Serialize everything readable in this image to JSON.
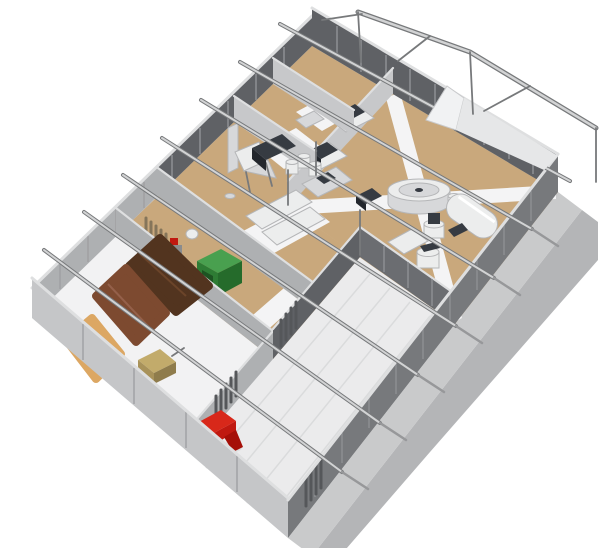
{
  "scene": {
    "type": "3d-isometric-cutaway-render",
    "subject": "Roofless cutaway model of a small feed-processing / mill facility viewed from above at an angle",
    "background": "#ffffff"
  },
  "palette": {
    "bg": "#ffffff",
    "floor_base": "#f2f2f3",
    "floor_tan": "#c9a87c",
    "floor_white": "#f4f4f5",
    "bay_floor": "#ebebec",
    "plank_line": "#dadbdc",
    "slab": "#c9cacb",
    "shadow": "#b4b5b7",
    "wall_dark": "#5f6165",
    "wall_dark2": "#6b6d71",
    "wall_mid": "#aeb0b2",
    "wall_light": "#c7c8ca",
    "wall_outer": "#c5c6c8",
    "wall_se": "#77797c",
    "wall_cap": "#dedfe0",
    "wall_rib_light": "#8b8d91",
    "wall_seam": "#9fa0a2",
    "metal": "#d2d3d4",
    "metal_dark": "#77797b",
    "stub": "#97989a",
    "slat_dark": "#55575a",
    "slat_wood": "#85755a",
    "pile_dark": "#52341f",
    "pile_red": "#7d4a30",
    "pile_tan": "#dca763",
    "green_top": "#49a04f",
    "green_front": "#2e7c34",
    "green_side": "#256b2b",
    "green_door": "#1d5422",
    "red_top": "#d8281a",
    "red_front": "#a50f08",
    "red_side": "#c01910",
    "tan_top": "#c2ab6b",
    "tan_front": "#a8925a",
    "tan_side": "#8f7c4c",
    "equip_white": "#eceded",
    "equip_shade": "#d7d8da",
    "equip_stroke": "#b5b6b8",
    "equip_dark": "#363b42",
    "equip_darker": "#23272d"
  },
  "building": {
    "footprint_px": {
      "west": [
        32,
        318
      ],
      "north": [
        312,
        46
      ],
      "east": [
        558,
        192
      ],
      "south": [
        288,
        538
      ]
    },
    "rooms": [
      {
        "name": "bulk-storage-room",
        "position": "south-west end",
        "features": [
          "dark-brown-pile",
          "red-brown-pile",
          "tan-pile",
          "bagging-machine",
          "louvered-gate"
        ]
      },
      {
        "name": "generator-room",
        "position": "mid north-west row",
        "features": [
          "green-generator",
          "small-mixer",
          "wood-slat-screen"
        ]
      },
      {
        "name": "milling-room",
        "position": "center north-west row",
        "features": [
          "duct",
          "cyclone-separator",
          "mill-block",
          "storage-bins",
          "sink-counter",
          "work-tables"
        ]
      },
      {
        "name": "packing-room-1",
        "position": "north-east row",
        "features": [
          "packing-table",
          "sealer-machine"
        ]
      },
      {
        "name": "packing-room-2",
        "position": "north corner",
        "features": [
          "packing-table",
          "sealer-machine"
        ]
      },
      {
        "name": "process-room",
        "position": "east side",
        "features": [
          "stone-mill",
          "horizontal-tank",
          "kettle",
          "kettle",
          "console",
          "side-table",
          "crossed-walkways"
        ]
      },
      {
        "name": "open-bay",
        "position": "south side",
        "features": [
          "red-grinder",
          "concrete-plank-floor"
        ]
      }
    ],
    "roof": {
      "state": "cut away",
      "purlin_count": 7,
      "canopy": "open gable steel frame extending past the north-east end wall"
    },
    "ground": {
      "apron": "concrete strip along the south-east wall",
      "shadow": "cast to the south-east"
    }
  }
}
